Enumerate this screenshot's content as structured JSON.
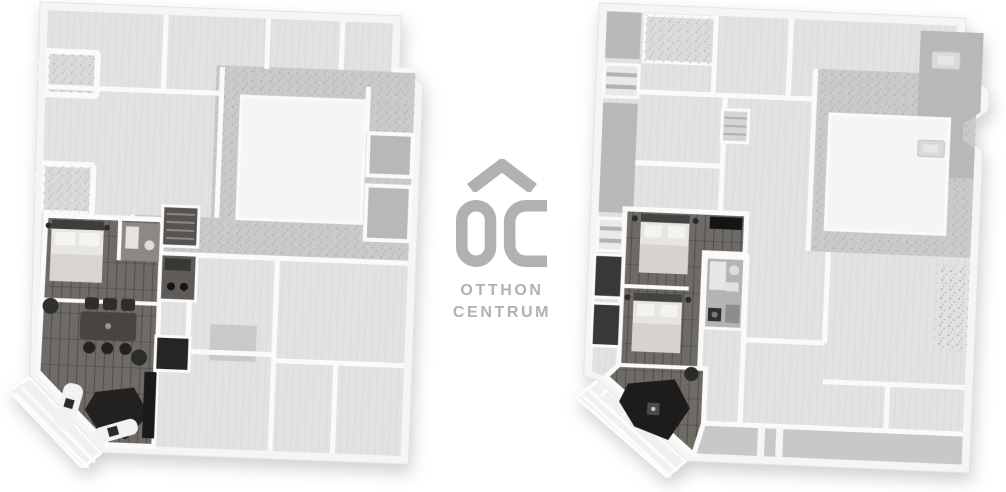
{
  "logo": {
    "monogram": "OC",
    "line1": "OTTHON",
    "line2": "CENTRUM"
  },
  "colors": {
    "page-bg": "#ffffff",
    "logo-gray": "#b1b1b1",
    "wall": "#fafafa",
    "shell": "#f5f5f6",
    "room": "#e1e2e4",
    "room-dark": "#b6b8ba",
    "court-band": "#c8cacc",
    "court-white": "#f5f5f6",
    "apt-floor": "#6e6b67",
    "terrace": "#f0f0f1"
  }
}
